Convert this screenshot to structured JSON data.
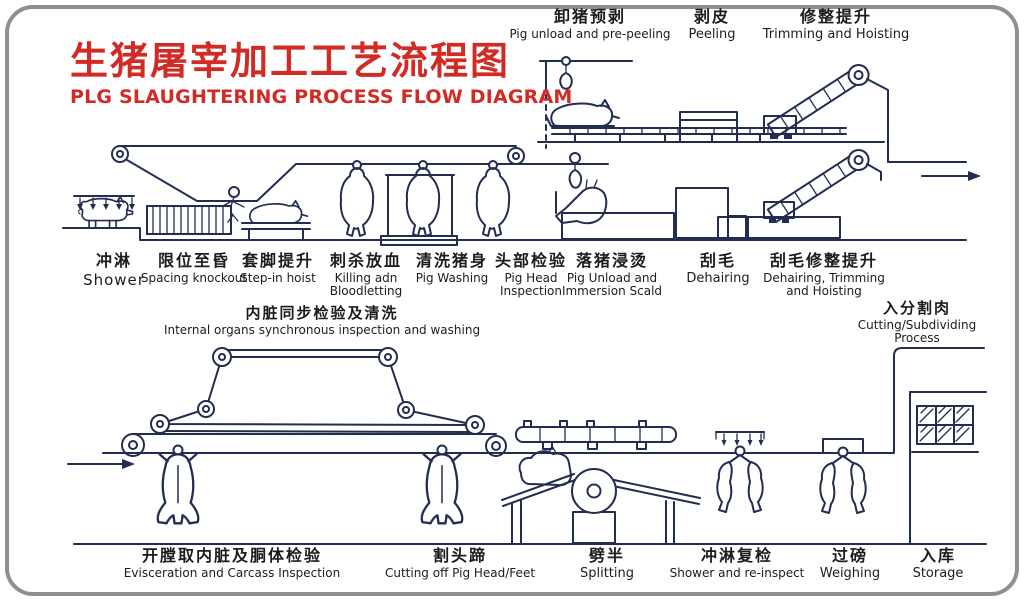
{
  "title": {
    "zh": "生猪屠宰加工工艺流程图",
    "en": "PLG SLAUGHTERING PROCESS FLOW DIAGRAM"
  },
  "stations": {
    "top": [
      {
        "zh": "卸猪预剥",
        "en": "Pig unload and pre-peeling"
      },
      {
        "zh": "剥皮",
        "en": "Peeling"
      },
      {
        "zh": "修整提升",
        "en": "Trimming and Hoisting"
      }
    ],
    "middle": [
      {
        "zh": "冲淋",
        "en": "Shower"
      },
      {
        "zh": "限位至昏",
        "en": "Spacing knockout"
      },
      {
        "zh": "套脚提升",
        "en": "Step-in hoist"
      },
      {
        "zh": "刺杀放血",
        "en": "Killing adn Bloodletting"
      },
      {
        "zh": "清洗猪身",
        "en": "Pig Washing"
      },
      {
        "zh": "头部检验",
        "en": "Pig Head Inspection"
      },
      {
        "zh": "落猪浸烫",
        "en": "Pig Unload and Immersion Scald"
      },
      {
        "zh": "刮毛",
        "en": "Dehairing"
      },
      {
        "zh": "刮毛修整提升",
        "en": "Dehairing, Trimming and Hoisting"
      }
    ],
    "sections": [
      {
        "zh": "内脏同步检验及清洗",
        "en": "Internal organs synchronous inspection and washing"
      },
      {
        "zh": "入分割肉",
        "en": "Cutting/Subdividing Process"
      }
    ],
    "bottom": [
      {
        "zh": "开膛取内脏及胴体检验",
        "en": "Evisceration and Carcass Inspection"
      },
      {
        "zh": "割头蹄",
        "en": "Cutting off Pig Head/Feet"
      },
      {
        "zh": "劈半",
        "en": "Splitting"
      },
      {
        "zh": "冲淋复检",
        "en": "Shower and re-inspect"
      },
      {
        "zh": "过磅",
        "en": "Weighing"
      },
      {
        "zh": "入库",
        "en": "Storage"
      }
    ]
  },
  "colors": {
    "line": "#232d52",
    "title": "#d22b25",
    "label": "#1c1c1c",
    "border": "#8f8f8f"
  }
}
